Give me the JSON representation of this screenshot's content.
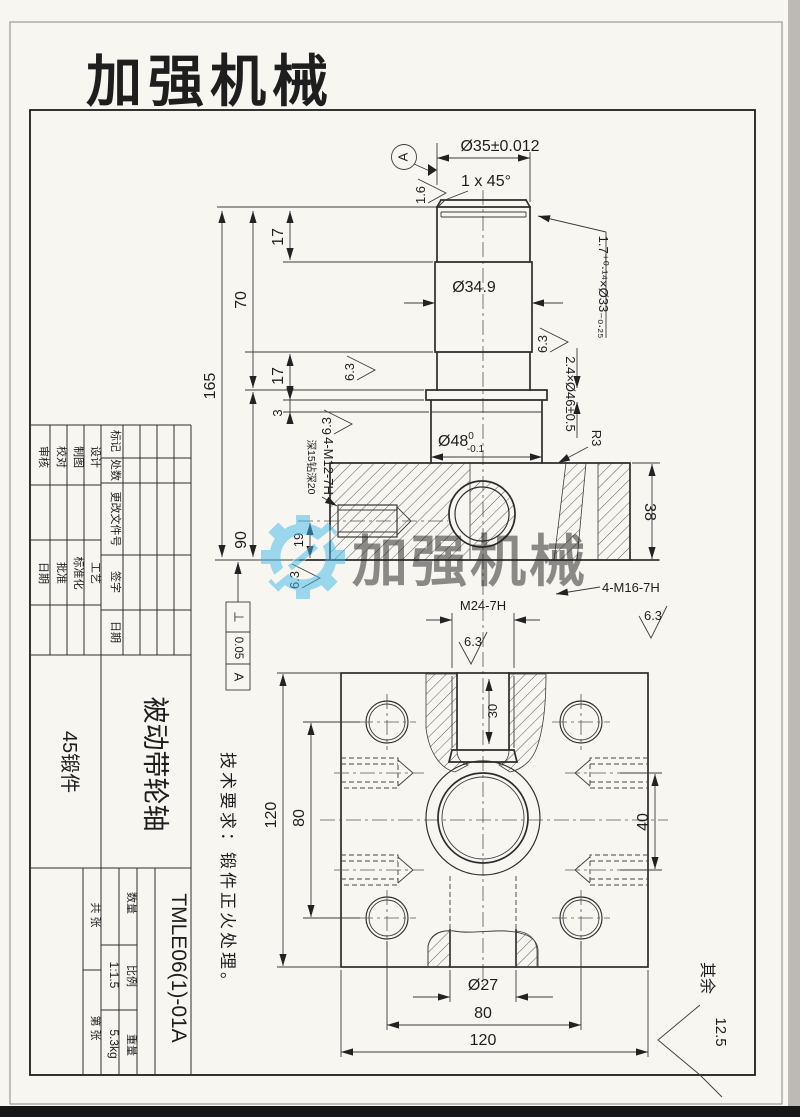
{
  "logo": {
    "text": "加强机械",
    "color": "#e2171a"
  },
  "watermark": {
    "text": "加强机械",
    "color": "#3fb7e9"
  },
  "technical_note": "技术要求：锻件正火处理。",
  "roughness_63": "6.3",
  "general_roughness": {
    "prefix": "其余",
    "value": "12.5"
  },
  "front_view": {
    "datum_label": "A",
    "roughness_top": "1.6",
    "dim_d35": "Ø35±0.012",
    "chamfer": "1 x 45°",
    "groove_top_note": "1.7⁺⁰·¹⁴×Ø33₋₀.₂₅",
    "groove_mid_note": "2.4×Ø46±0.5",
    "dim_d349": "Ø34.9",
    "d48_base": "Ø48",
    "d48_tol_upper": "0",
    "d48_tol_lower": "-0.1",
    "fillet": "R3",
    "dim_17_top": "17",
    "dim_70": "70",
    "dim_17_mid": "17",
    "dim_3": "3",
    "dim_165": "165",
    "dim_90": "90",
    "dim_38": "38",
    "dim_19": "19",
    "thread_side": "4-M12-7H",
    "thread_side_depth": "深15钻深20",
    "thread_bottom": "4-M16-7H",
    "tolerance_frame": {
      "symbol": "⊥",
      "value": "0.05",
      "datum": "A"
    }
  },
  "bottom_view": {
    "thread_center": "M24-7H",
    "dim_30": "30",
    "dim_40": "40",
    "dim_120_left": "120",
    "dim_80_left": "80",
    "dim_d27": "Ø27",
    "dim_80_bottom": "80",
    "dim_120_bottom": "120"
  },
  "title_block": {
    "rev_labels": [
      "标记",
      "处数",
      "更改文件号",
      "签字",
      "日期"
    ],
    "roles_top": [
      "审核",
      "校对",
      "制图",
      "设计"
    ],
    "roles_bottom": [
      "日期",
      "批准",
      "标准化",
      "工艺"
    ],
    "part_name": "被动带轮轴",
    "material": "45锻件",
    "drawing_number": "TMLE06(1)-01A",
    "qty_label": "数量",
    "scale_label": "比例",
    "scale_value": "1:1.5",
    "weight_label": "重量",
    "weight_value": "5.3kg",
    "sheet_total_label": "共  张",
    "sheet_index_label": "第  张"
  }
}
